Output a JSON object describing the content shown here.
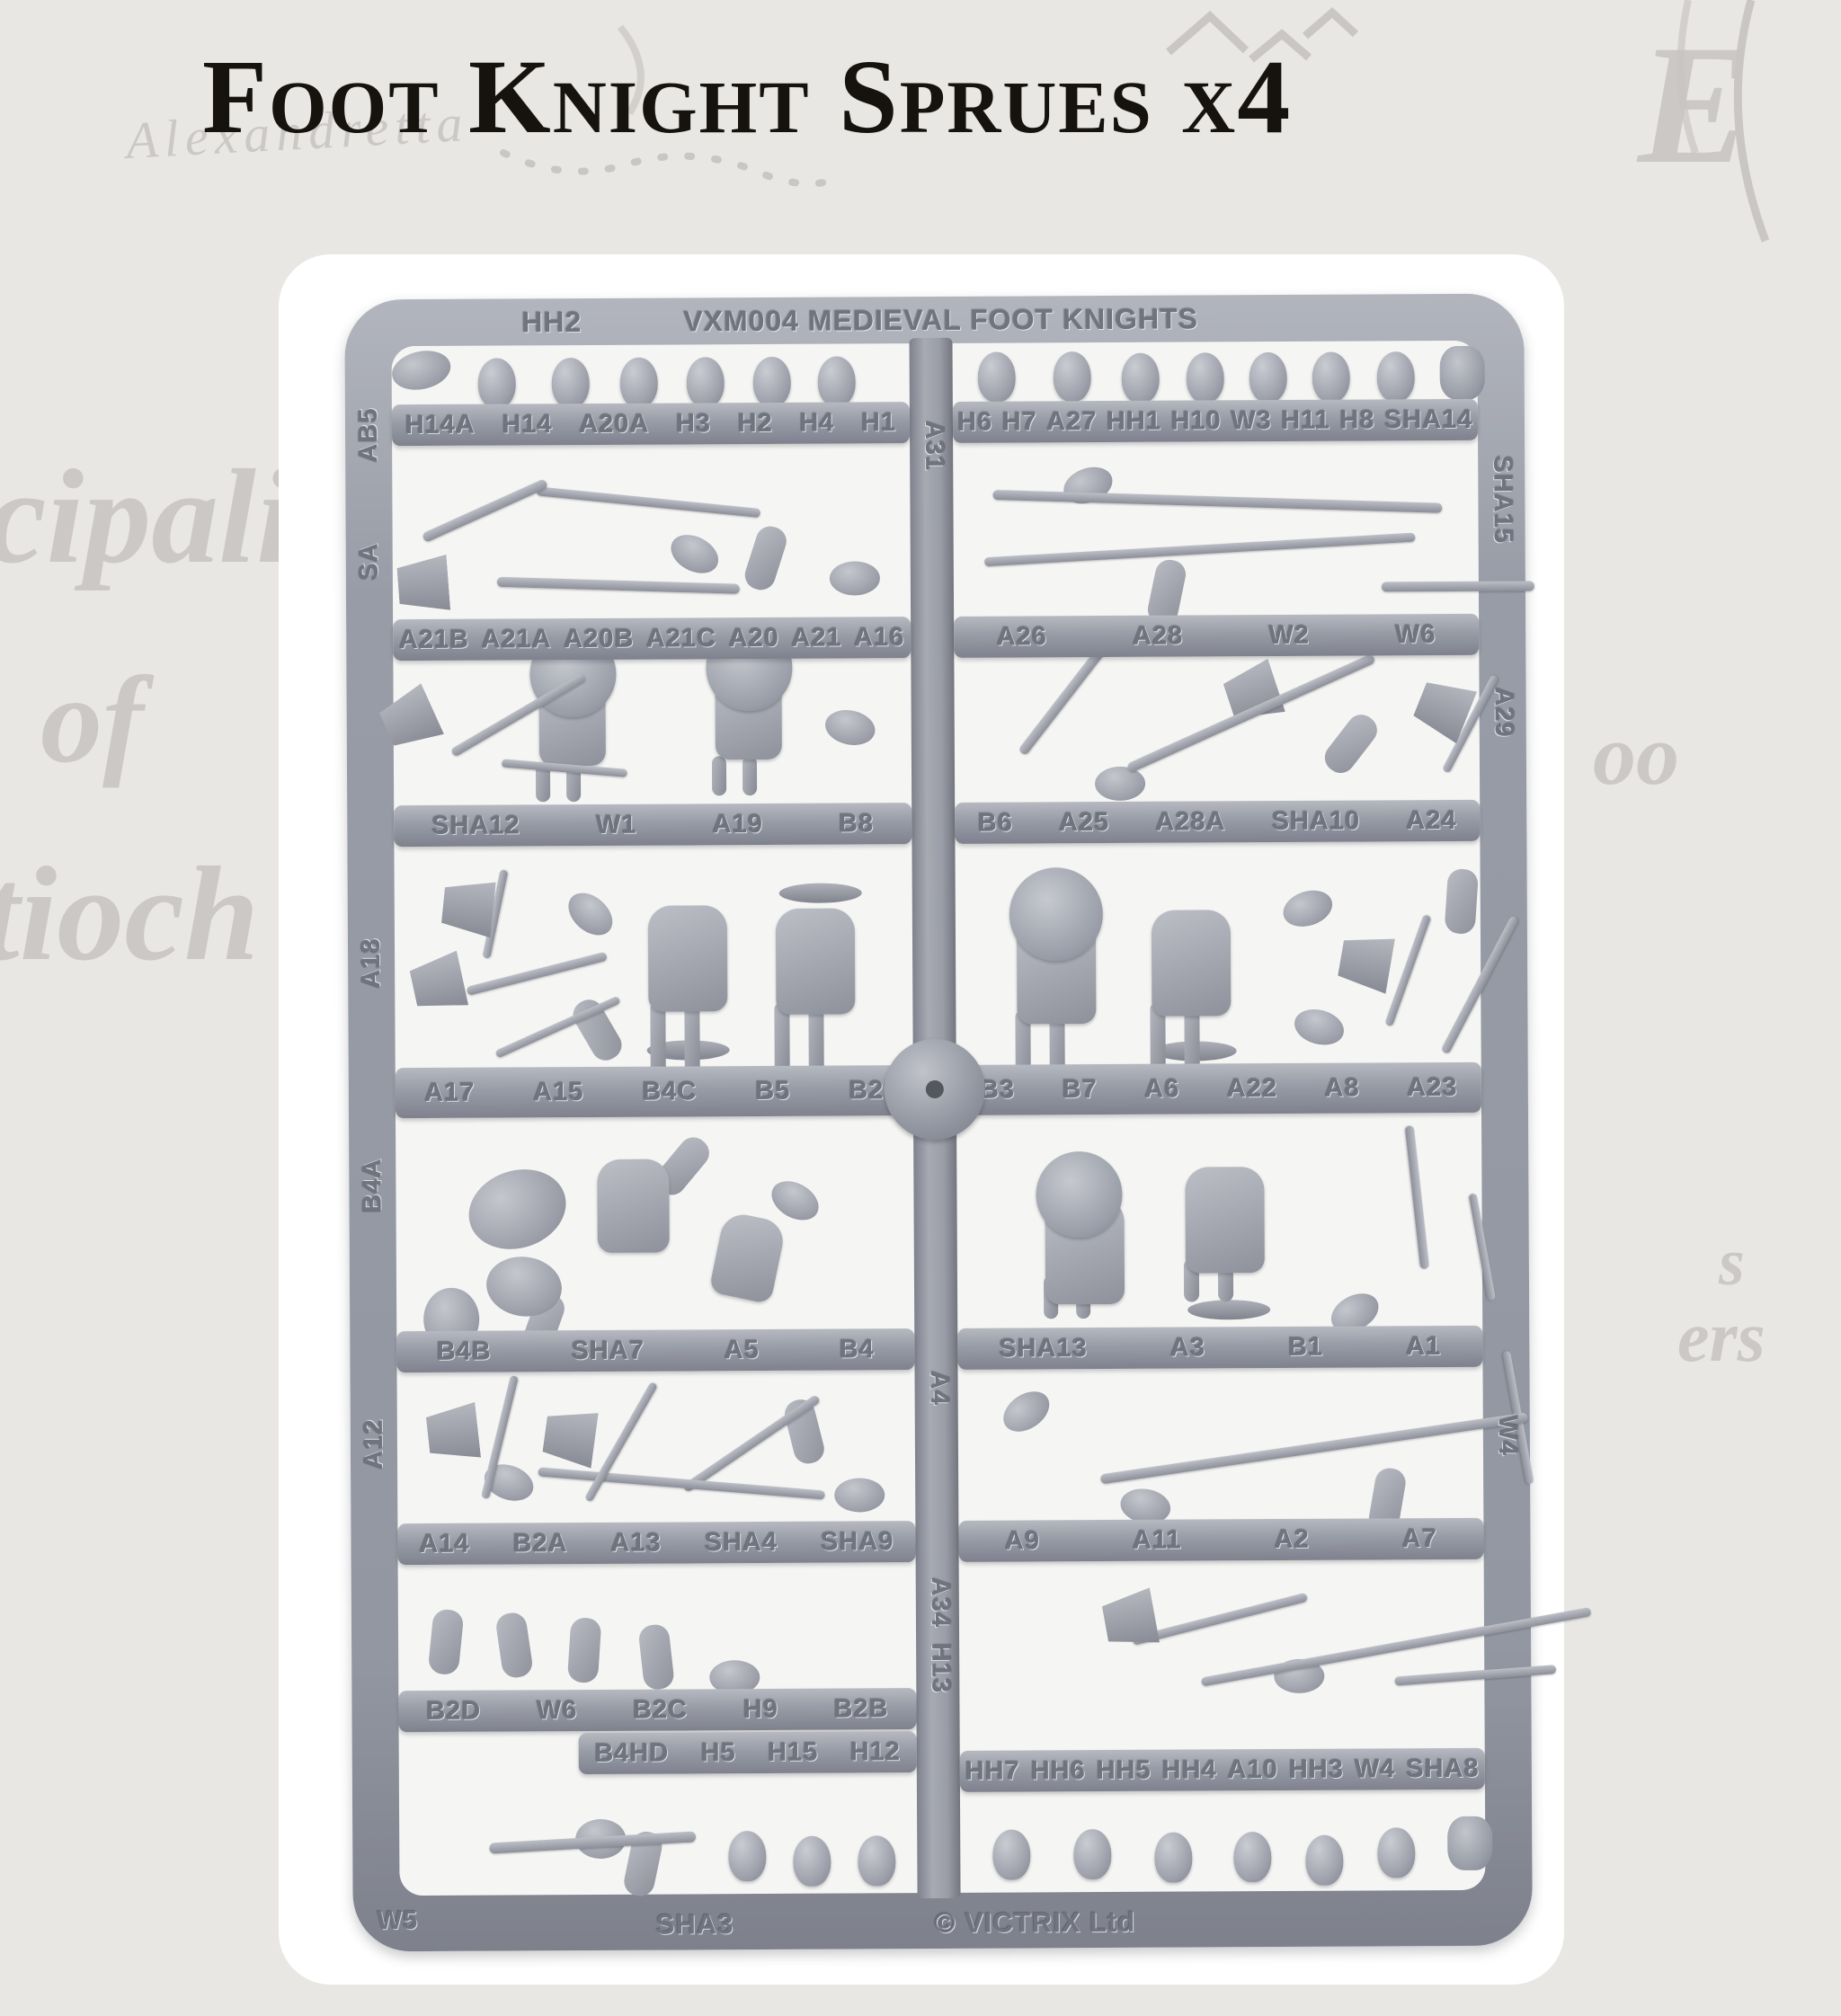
{
  "page": {
    "title": "Foot Knight Sprues x4"
  },
  "background": {
    "words": [
      {
        "name": "map-word-alexandretta",
        "text": "Alexandretta"
      },
      {
        "name": "map-word-initial-e",
        "text": "E"
      },
      {
        "name": "map-word-cipali",
        "text": "cipali"
      },
      {
        "name": "map-word-of",
        "text": "of"
      },
      {
        "name": "map-word-tioch",
        "text": "tioch"
      },
      {
        "name": "map-word-oo",
        "text": "oo"
      },
      {
        "name": "map-word-s",
        "text": "s"
      },
      {
        "name": "map-word-ers",
        "text": "ers"
      }
    ]
  },
  "sprue": {
    "top_bar": {
      "left_label": "HH2",
      "title": "VXM004 MEDIEVAL FOOT KNIGHTS"
    },
    "bottom_bar": {
      "left_label": "W5",
      "center_label": "SHA3",
      "maker_label": "© VICTRIX Ltd"
    },
    "left_rail_labels": [
      "AB5",
      "SA",
      "A18",
      "B4A",
      "A12"
    ],
    "center_rail_labels": [
      "A31",
      "A4",
      "A34",
      "H13"
    ],
    "right_rail_labels": [
      "SHA15",
      "A29",
      "W4"
    ],
    "rails": [
      {
        "left": [
          "H14A",
          "H14",
          "A20A",
          "H3",
          "H2",
          "H4",
          "H1"
        ],
        "right": [
          "H6",
          "H7",
          "A27",
          "HH1",
          "H10",
          "W3",
          "H11",
          "H8",
          "SHA14"
        ]
      },
      {
        "left": [
          "A21B",
          "A21A",
          "A20B",
          "A21C",
          "A20",
          "A21",
          "A16"
        ],
        "right": [
          "A26",
          "A28",
          "W2",
          "W6"
        ]
      },
      {
        "left": [
          "SHA12",
          "W1",
          "A19",
          "B8"
        ],
        "right": [
          "B6",
          "A25",
          "A28A",
          "SHA10",
          "A24"
        ]
      },
      {
        "left": [
          "A17",
          "A15",
          "B4C",
          "B5",
          "B2"
        ],
        "right": [
          "B3",
          "B7",
          "A6",
          "A22",
          "A8",
          "A23"
        ]
      },
      {
        "left": [
          "B4B",
          "SHA7",
          "A5",
          "B4"
        ],
        "right": [
          "SHA13",
          "A3",
          "B1",
          "A1"
        ]
      },
      {
        "left": [
          "A14",
          "B2A",
          "A13",
          "SHA4",
          "SHA9"
        ],
        "right": [
          "A9",
          "A11",
          "A2",
          "A7"
        ]
      },
      {
        "left": [
          "B2D",
          "W6",
          "B2C",
          "H9",
          "B2B"
        ],
        "left2": [
          "B4HD",
          "H5",
          "H15",
          "H12"
        ],
        "right": [
          "HH7",
          "HH6",
          "HH5",
          "HH4",
          "A10",
          "HH3",
          "W4",
          "SHA8"
        ]
      }
    ]
  },
  "colors": {
    "background": "#e9e7e4",
    "faded_text": "#c8c5c2",
    "card": "#ffffff",
    "sprue_gray": "#9397a1",
    "sprue_light": "#b6b9c0",
    "sprue_dark": "#7f828e",
    "title_text": "#16130f",
    "molded_label": "#70747f"
  }
}
